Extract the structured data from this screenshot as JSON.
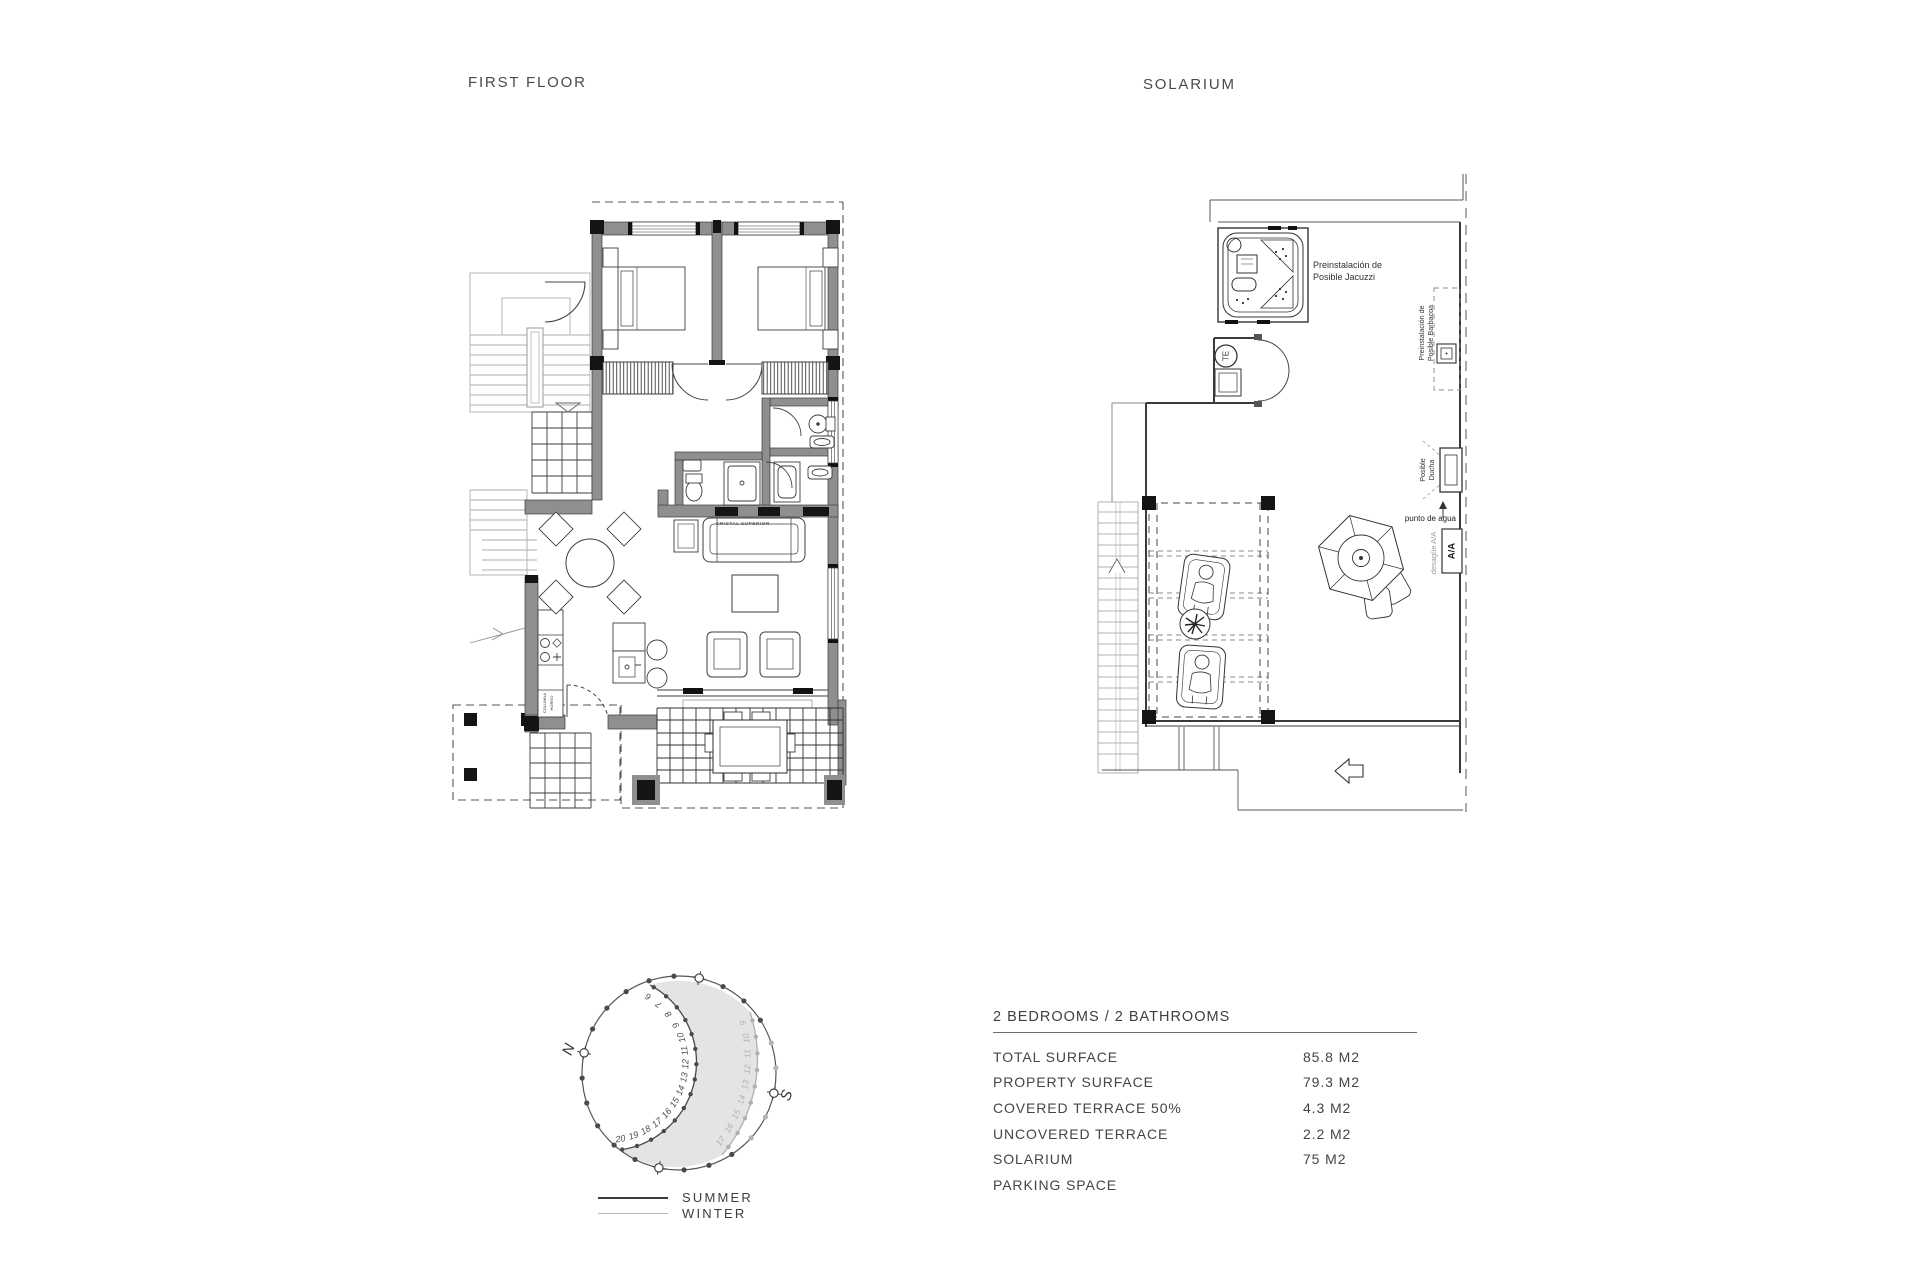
{
  "titles": {
    "first_floor": "FIRST FLOOR",
    "solarium": "SOLARIUM"
  },
  "first_floor_plan": {
    "labels": {
      "cristal_superior": "CRISTAL SUPERIOR",
      "columna_1": "COLUMNA",
      "columna_2": "HORNO"
    }
  },
  "solarium_plan": {
    "labels": {
      "jacuzzi_1": "Preinstalación de",
      "jacuzzi_2": "Posible Jacuzzi",
      "barbacoa_1": "Preinstalación de",
      "barbacoa_2": "Posible Barbacoa",
      "ducha_1": "Posible",
      "ducha_2": "Ducha",
      "punto_agua": "punto de agua",
      "desague": "desagüe A/A",
      "aa": "A/A",
      "te": "TE"
    }
  },
  "sun_diagram": {
    "north": "N",
    "south": "S",
    "summer_hours": [
      "6",
      "7",
      "8",
      "9",
      "10",
      "11",
      "12",
      "13",
      "14",
      "15",
      "16",
      "17",
      "18",
      "19",
      "20"
    ],
    "winter_hours": [
      "9",
      "10",
      "11",
      "12",
      "13",
      "14",
      "15",
      "16",
      "17"
    ],
    "colors": {
      "summer": "#4a4a4a",
      "winter": "#b0b0b0",
      "shade": "#e4e4e4",
      "dot": "#4a4a4a",
      "dot_light": "#b3b3b3"
    },
    "legend": [
      {
        "label": "SUMMER",
        "color": "#3d3d3d"
      },
      {
        "label": "WINTER",
        "color": "#b8b8b8"
      }
    ]
  },
  "spec_table": {
    "header": "2 BEDROOMS / 2 BATHROOMS",
    "rows": [
      {
        "label": "TOTAL SURFACE",
        "value": "85.8 M2"
      },
      {
        "label": "PROPERTY SURFACE",
        "value": "79.3 M2"
      },
      {
        "label": "COVERED TERRACE 50%",
        "value": "4.3 M2"
      },
      {
        "label": "UNCOVERED TERRACE",
        "value": "2.2 M2"
      },
      {
        "label": "SOLARIUM",
        "value": "75 M2"
      },
      {
        "label": "PARKING SPACE",
        "value": ""
      }
    ]
  }
}
